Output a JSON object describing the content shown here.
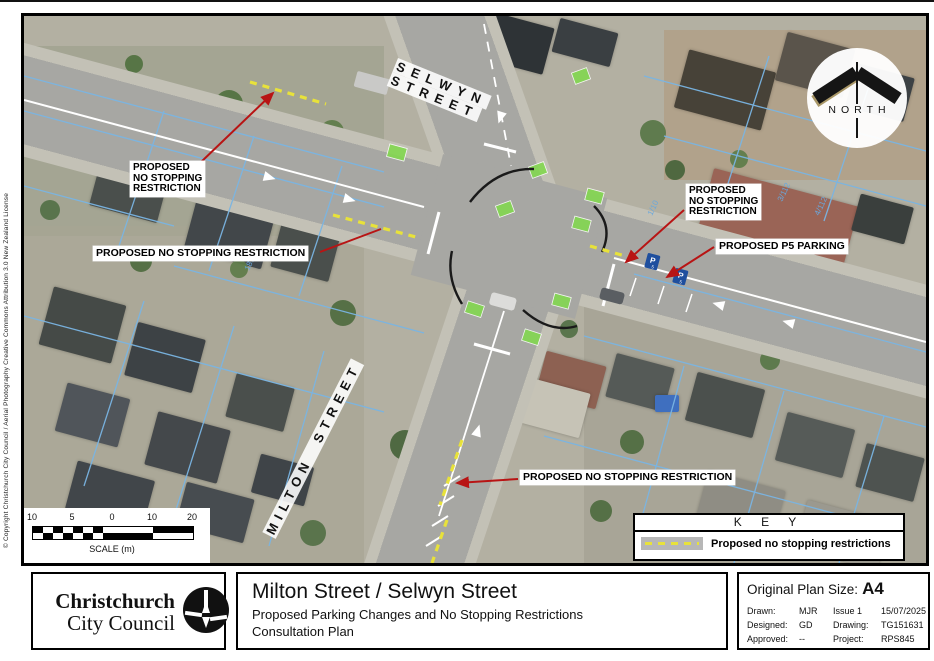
{
  "page": {
    "copyright": "© Copyright Christchurch City Council / Aerial Photography Creative Commons Attribution 3.0 New Zealand License"
  },
  "map": {
    "north_label": "NORTH",
    "streets": {
      "selwyn_line1": "SELWYN",
      "selwyn_line2": "STREET",
      "milton": "MILTON STREET"
    },
    "annotations": {
      "nw": [
        "PROPOSED",
        "NO STOPPING",
        "RESTRICTION"
      ],
      "west": "PROPOSED NO STOPPING RESTRICTION",
      "east": [
        "PROPOSED",
        "NO STOPPING",
        "RESTRICTION"
      ],
      "p5": "PROPOSED P5 PARKING",
      "south": "PROPOSED NO STOPPING RESTRICTION"
    },
    "parcels": [
      "1/10",
      "3/112",
      "4/112",
      "181"
    ],
    "p_sign": "P",
    "p_sign_small": "5",
    "scalebar": {
      "ticks": [
        "10",
        "5",
        "0",
        "10",
        "20"
      ],
      "caption": "SCALE (m)"
    },
    "key": {
      "title": "K E Y",
      "entry": "Proposed no stopping restrictions"
    }
  },
  "footer": {
    "logo_line1": "Christchurch",
    "logo_line2": "City Council",
    "title_main": "Milton Street / Selwyn Street",
    "title_sub1": "Proposed Parking Changes and No Stopping Restrictions",
    "title_sub2": "Consultation Plan",
    "info": {
      "plan_size_label": "Original Plan Size:",
      "plan_size_value": "A4",
      "rows": [
        [
          "Drawn:",
          "MJR",
          "Issue 1",
          "15/07/2025"
        ],
        [
          "Designed:",
          "GD",
          "Drawing:",
          "TG151631"
        ],
        [
          "Approved:",
          "--",
          "Project:",
          "RPS845"
        ]
      ]
    }
  },
  "colors": {
    "leader_red": "#b81414",
    "no_stopping_yellow": "#e8e23a",
    "cadastral_blue": "#7ab5e3",
    "cycle_green": "#82d84e",
    "p_sign_blue": "#1f4f9e",
    "road_gray": "#a7a7a3"
  }
}
